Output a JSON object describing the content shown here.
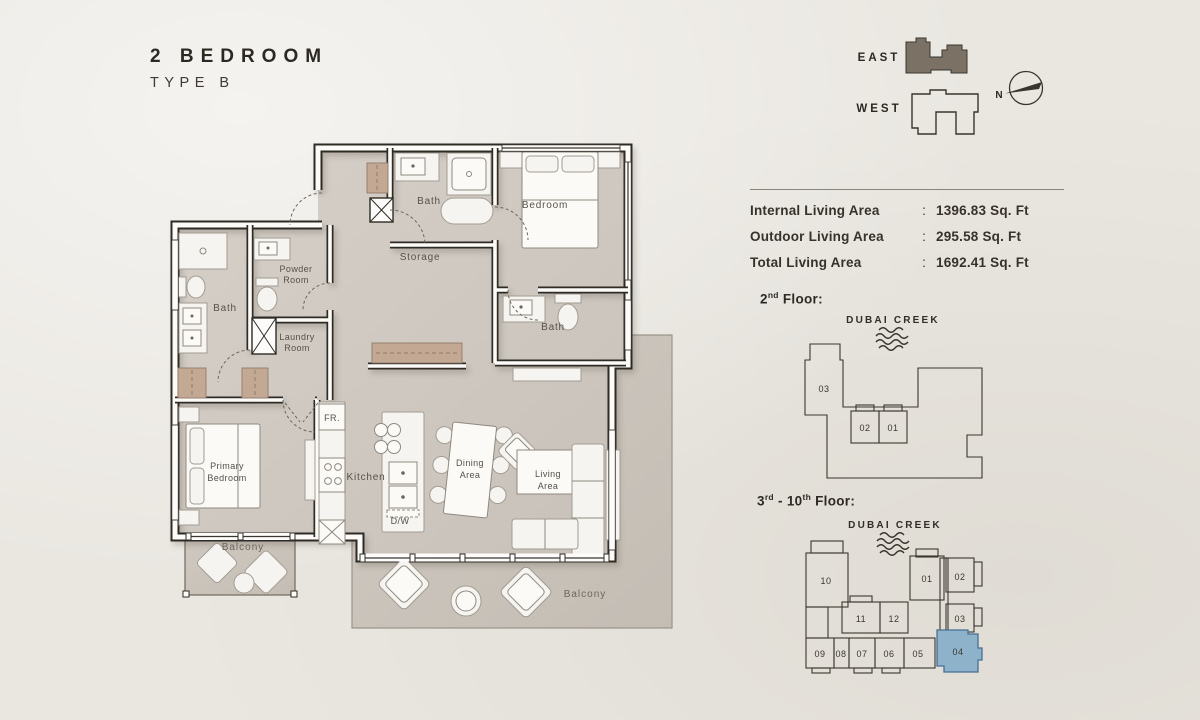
{
  "title": {
    "line1": "2 BEDROOM",
    "line2": "TYPE B"
  },
  "orientation": {
    "east": "EAST",
    "west": "WEST",
    "north": "N"
  },
  "area_table": {
    "rows": [
      {
        "label": "Internal Living Area",
        "colon": ":",
        "value": "1396.83 Sq. Ft"
      },
      {
        "label": "Outdoor Living Area",
        "colon": ":",
        "value": "295.58 Sq. Ft"
      },
      {
        "label": "Total Living Area",
        "colon": ":",
        "value": "1692.41 Sq. Ft"
      }
    ]
  },
  "floor2": {
    "heading": {
      "num": "2",
      "sup": "nd",
      "rest": " Floor:"
    },
    "creek": "DUBAI CREEK",
    "units": [
      "03",
      "02",
      "01"
    ]
  },
  "floor3": {
    "heading": {
      "n1": "3",
      "s1": "rd",
      "mid": " - 10",
      "s2": "th",
      "rest": " Floor:"
    },
    "creek": "DUBAI CREEK",
    "units": [
      "10",
      "01",
      "02",
      "11",
      "12",
      "03",
      "09",
      "08",
      "07",
      "06",
      "05",
      "04"
    ],
    "highlighted_unit": "04"
  },
  "plan": {
    "bath_top": "Bath",
    "bedroom": "Bedroom",
    "storage": "Storage",
    "powder1": "Powder",
    "powder2": "Room",
    "bath_left": "Bath",
    "laundry1": "Laundry",
    "laundry2": "Room",
    "bath_ensuite": "Bath",
    "primary1": "Primary",
    "primary2": "Bedroom",
    "fridge": "FR.",
    "kitchen": "Kitchen",
    "dishwasher": "D/W",
    "dining1": "Dining",
    "dining2": "Area",
    "living1": "Living",
    "living2": "Area",
    "balcony_left": "Balcony",
    "balcony_main": "Balcony"
  },
  "colors": {
    "background": "#eae7e1",
    "floor": "#d1cac3",
    "balcony": "#cac3bb",
    "wall": "#2e2b25",
    "wood": "#c3a893",
    "highlight_unit": "#8fb2cb",
    "east_icon_fill": "#7b7265"
  }
}
